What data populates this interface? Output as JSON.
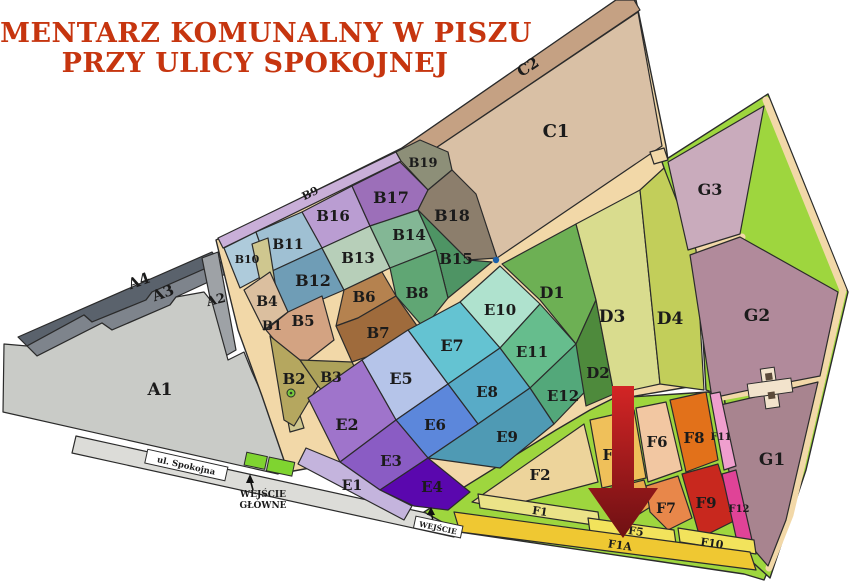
{
  "title": {
    "line1": "CMENTARZ KOMUNALNY W PISZU",
    "line2": "PRZY ULICY SPOKOJNEJ",
    "color": "#C6350F"
  },
  "map": {
    "road": {
      "name": "ul. Spokojna",
      "fill": "#DCDCD8"
    },
    "entrances": {
      "main_line1": "WEJŚCIE",
      "main_line2": "GŁÓWNE",
      "side": "WEJŚCIE",
      "gate_color": "#7FD430"
    },
    "markers": {
      "junction_dot": "#1B5FAA",
      "entrance_dot": "#76C93C"
    },
    "arrow": {
      "top": "#D32525",
      "bottom": "#6E1013"
    },
    "path_color": "#F2D8A8",
    "f_ground": "#9ED63E",
    "building_color": "#F2E3CC",
    "text_color": "#1b1b1b",
    "sections": {
      "A1": {
        "label": "A1",
        "color": "#C9CBC7"
      },
      "A2": {
        "label": "A2",
        "color": "#9EA2A6"
      },
      "A3": {
        "label": "A3",
        "color": "#7E848C"
      },
      "A4": {
        "label": "A4",
        "color": "#5A626C"
      },
      "B1": {
        "label": "B1",
        "color": "#CFC78F"
      },
      "B2": {
        "label": "B2",
        "color": "#B5A75F"
      },
      "B3": {
        "label": "B3",
        "color": "#ADA25A"
      },
      "B4": {
        "label": "B4",
        "color": "#DBBF9F"
      },
      "B5": {
        "label": "B5",
        "color": "#D3A382"
      },
      "B6": {
        "label": "B6",
        "color": "#B5824F"
      },
      "B7": {
        "label": "B7",
        "color": "#9F6B3C"
      },
      "B8": {
        "label": "B8",
        "color": "#60A674"
      },
      "B9": {
        "label": "B9",
        "color": "#C9AFD8"
      },
      "B10": {
        "label": "B10",
        "color": "#AECBDB"
      },
      "B11": {
        "label": "B11",
        "color": "#9FC0D3"
      },
      "B12": {
        "label": "B12",
        "color": "#6F9DB6"
      },
      "B13": {
        "label": "B13",
        "color": "#B7CFB9"
      },
      "B14": {
        "label": "B14",
        "color": "#83B795"
      },
      "B15": {
        "label": "B15",
        "color": "#4E9464"
      },
      "B16": {
        "label": "B16",
        "color": "#BA9DD2"
      },
      "B17": {
        "label": "B17",
        "color": "#9C6FB9"
      },
      "B18": {
        "label": "B18",
        "color": "#8C7E6C"
      },
      "B19": {
        "label": "B19",
        "color": "#8D8F78"
      },
      "C1": {
        "label": "C1",
        "color": "#D9C0A5"
      },
      "C2": {
        "label": "C2",
        "color": "#C5A183"
      },
      "D1": {
        "label": "D1",
        "color": "#6DB054"
      },
      "D2": {
        "label": "D2",
        "color": "#4E8A3C"
      },
      "D3": {
        "label": "D3",
        "color": "#D9DC8E"
      },
      "D4": {
        "label": "D4",
        "color": "#C2CE5A"
      },
      "E1": {
        "label": "E1",
        "color": "#C4B4DD"
      },
      "E2": {
        "label": "E2",
        "color": "#9F74CB"
      },
      "E3": {
        "label": "E3",
        "color": "#8A5CC4"
      },
      "E4": {
        "label": "E4",
        "color": "#5A07AE"
      },
      "E5": {
        "label": "E5",
        "color": "#B5C4E9"
      },
      "E6": {
        "label": "E6",
        "color": "#5C87DB"
      },
      "E7": {
        "label": "E7",
        "color": "#64C3D2"
      },
      "E8": {
        "label": "E8",
        "color": "#58ABC7"
      },
      "E9": {
        "label": "E9",
        "color": "#4F9AB4"
      },
      "E10": {
        "label": "E10",
        "color": "#AFE2CE"
      },
      "E11": {
        "label": "E11",
        "color": "#66BD8D"
      },
      "E12": {
        "label": "E12",
        "color": "#53A87A"
      },
      "F1": {
        "label": "F1",
        "color": "#EBE388"
      },
      "F1A": {
        "label": "F1A",
        "color": "#EFC832"
      },
      "F2": {
        "label": "F2",
        "color": "#EDD49B"
      },
      "F3": {
        "label": "F3",
        "color": "#EFC05A"
      },
      "F4": {
        "label": "F4",
        "color": "#E8A94B"
      },
      "F5": {
        "label": "F5",
        "color": "#F2E35C"
      },
      "F6": {
        "label": "F6",
        "color": "#F2C7A2"
      },
      "F7": {
        "label": "F7",
        "color": "#E8874A"
      },
      "F8": {
        "label": "F8",
        "color": "#E2711A"
      },
      "F9": {
        "label": "F9",
        "color": "#C8281E"
      },
      "F10": {
        "label": "F10",
        "color": "#F2E35C"
      },
      "F11": {
        "label": "F11",
        "color": "#EF9FCE"
      },
      "F12": {
        "label": "F12",
        "color": "#E04397"
      },
      "G1": {
        "label": "G1",
        "color": "#A8848F"
      },
      "G2": {
        "label": "G2",
        "color": "#B18A9B"
      },
      "G3": {
        "label": "G3",
        "color": "#C9ABBC"
      }
    }
  }
}
